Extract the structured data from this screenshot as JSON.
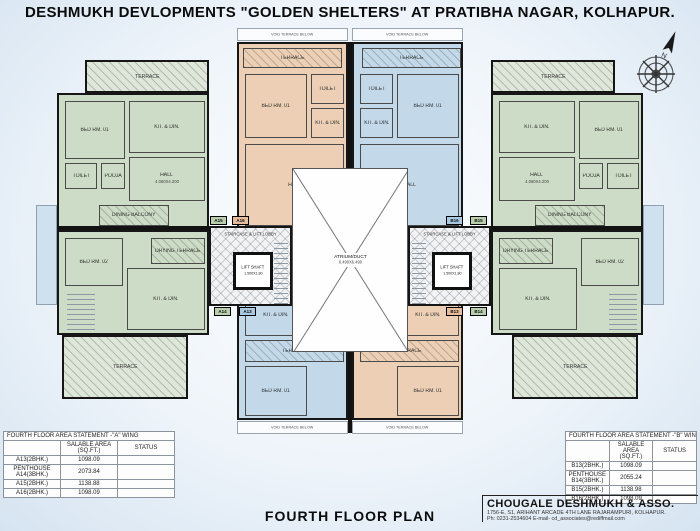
{
  "title": "DESHMUKH DEVLOPMENTS \"GOLDEN SHELTERS\" AT PRATIBHA NAGAR, KOLHAPUR.",
  "plan_title": "FOURTH FLOOR PLAN",
  "compass": {
    "north_label": "N"
  },
  "firm": {
    "name": "CHOUGALE DESHMUKH & ASSO.",
    "address": "1756-E, S1, ARIHANT ARCADE 4TH LANE RAJARAMPURI, KOLHAPUR.",
    "contact": "Ph: 0231-2534604   E-mail- cd_associates@rediffmail.com"
  },
  "rooms": {
    "bed1": "BED RM. 01",
    "bed2": "BED RM. 02",
    "toilet": "TOILET",
    "kitdin": "KIT. & DIN.",
    "hall": "HALL",
    "hall_dim": "4.060X4.200",
    "pooja": "POOJA",
    "terrace": "TERRACE",
    "drying_terrace": "DRYING TERRACE",
    "dining_balcony": "DINING BALCONY",
    "void_terrace": "VOID TERRACE BELOW"
  },
  "core": {
    "label": "STAIRCASE & LIFT LOBBY",
    "lift_label": "LIFT SHAFT",
    "lift_dim": "1.500X1.80"
  },
  "atrium": {
    "label": "ATRIUM/DUCT",
    "dim": "6.490X6.490"
  },
  "unit_tags": {
    "a15": "A15",
    "a16": "A16",
    "a14": "A14",
    "a13": "A13",
    "b16": "B16",
    "b15": "B15",
    "b13": "B13",
    "b14": "B14"
  },
  "area_tables": {
    "a_wing": {
      "title": "FOURTH FLOOR AREA STATEMENT -\"A\" WING",
      "columns": {
        "area1": "SALABLE AREA",
        "area2": "(SQ.FT.)",
        "status": "STATUS"
      },
      "rows": [
        {
          "unit": "A13(2BHK.)",
          "area": "1098.09",
          "status": ""
        },
        {
          "unit": "PENTHOUSE A14(3BHK.)",
          "area": "2073.84",
          "status": ""
        },
        {
          "unit": "A15(2BHK.)",
          "area": "1138.88",
          "status": ""
        },
        {
          "unit": "A16(2BHK.)",
          "area": "1098.09",
          "status": ""
        }
      ]
    },
    "b_wing": {
      "title": "FOURTH FLOOR AREA STATEMENT -\"B\" WING",
      "columns": {
        "area1": "SALABLE AREA",
        "area2": "(SQ.FT.)",
        "status": "STATUS"
      },
      "rows": [
        {
          "unit": "B13(2BHK.)",
          "area": "1098.09",
          "status": ""
        },
        {
          "unit": "PENTHOUSE B14(3BHK.)",
          "area": "2055.24",
          "status": ""
        },
        {
          "unit": "B15(2BHK.)",
          "area": "1138.98",
          "status": ""
        },
        {
          "unit": "B16(2BHK.)",
          "area": "1098.09",
          "status": ""
        }
      ]
    }
  },
  "colors": {
    "flat_green": "#cddcc6",
    "flat_peach": "#eccfb4",
    "flat_blue": "#c3d9ea",
    "wall": "#161616",
    "page_bg": "#d6e4f1"
  }
}
